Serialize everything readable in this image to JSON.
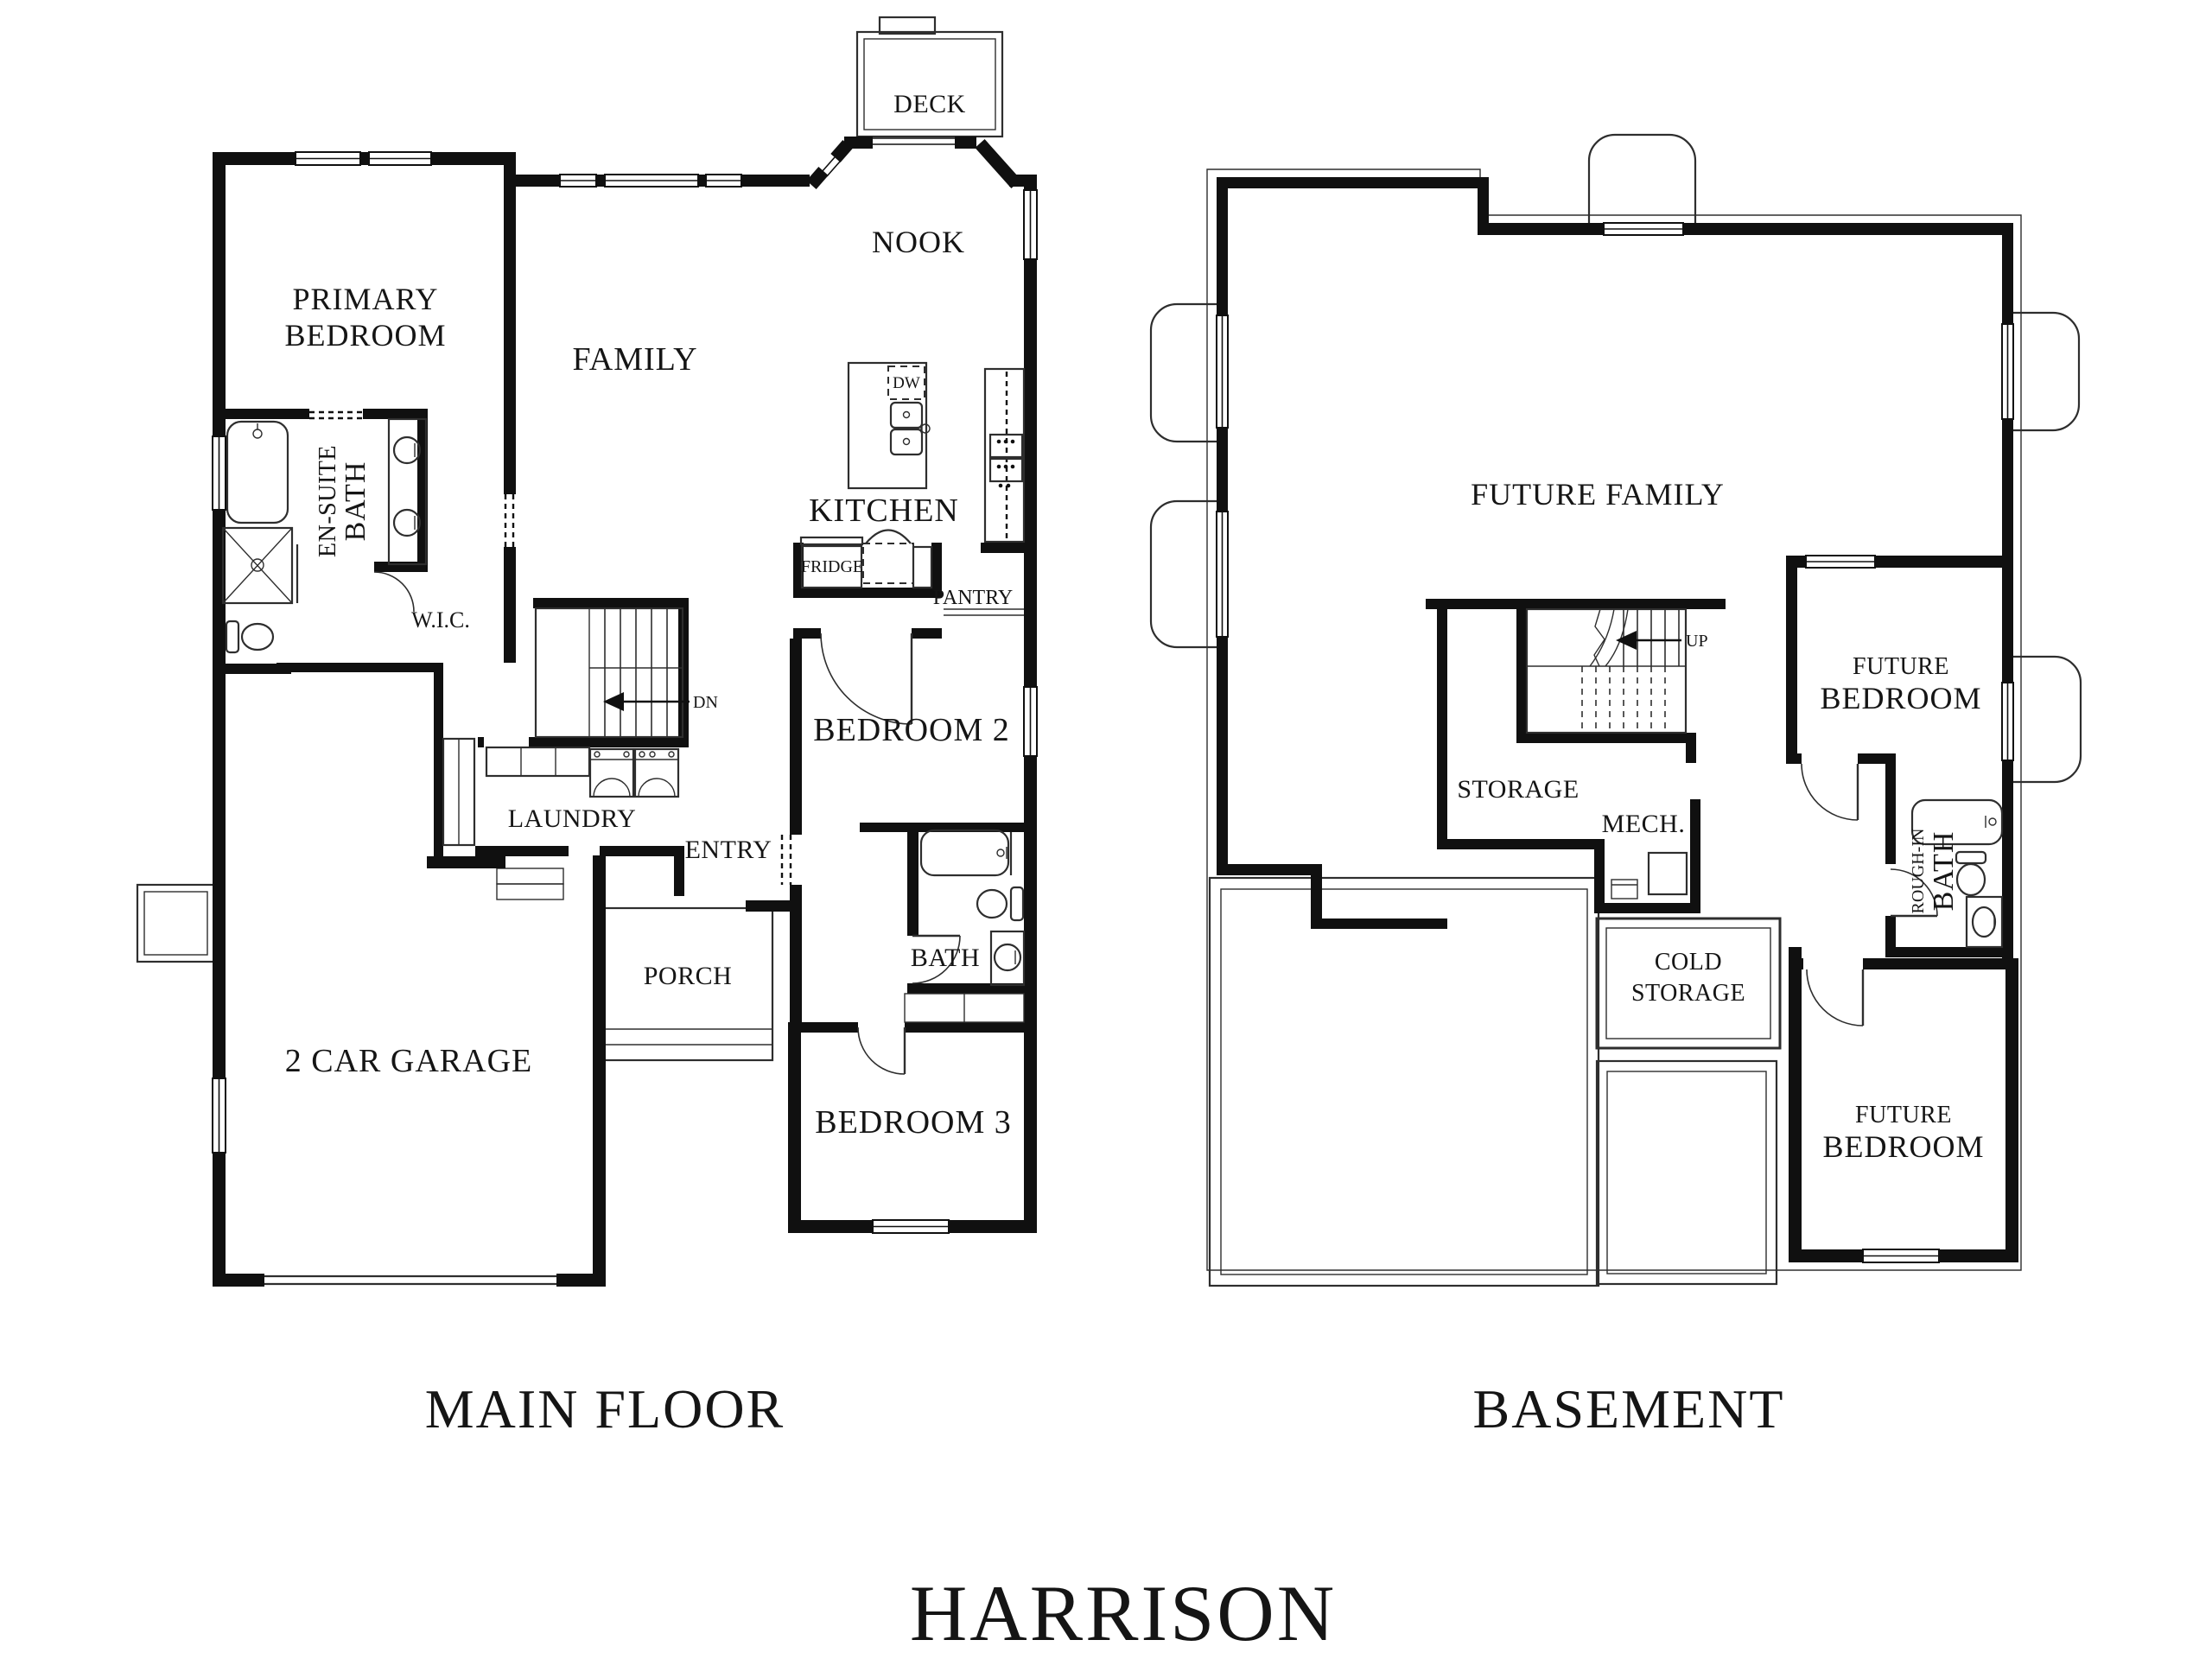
{
  "colors": {
    "walls": "#101010",
    "thin_lines": "#2e2e2e",
    "text": "#151515",
    "background": "#ffffff"
  },
  "title": "HARRISON",
  "main_floor": {
    "caption": "MAIN FLOOR",
    "labels": {
      "primary_bedroom": [
        "PRIMARY",
        "BEDROOM"
      ],
      "ensuite_bath": [
        "EN-SUITE",
        "BATH"
      ],
      "wic": "W.I.C.",
      "family": "FAMILY",
      "deck": "DECK",
      "nook": "NOOK",
      "kitchen": "KITCHEN",
      "dishwasher": "DW",
      "fridge": "FRIDGE",
      "pantry": "PANTRY",
      "stairs_down": "DN",
      "bedroom2": "BEDROOM 2",
      "laundry": "LAUNDRY",
      "entry": "ENTRY",
      "bath": "BATH",
      "porch": "PORCH",
      "garage": "2 CAR GARAGE",
      "bedroom3": "BEDROOM 3"
    }
  },
  "basement": {
    "caption": "BASEMENT",
    "labels": {
      "future_family": "FUTURE FAMILY",
      "stairs_up": "UP",
      "storage": "STORAGE",
      "mech": "MECH.",
      "cold_storage": [
        "COLD",
        "STORAGE"
      ],
      "future_bedroom_upper": [
        "FUTURE",
        "BEDROOM"
      ],
      "rough_in_bath": [
        "ROUGH-IN",
        "BATH"
      ],
      "future_bedroom_lower": [
        "FUTURE",
        "BEDROOM"
      ]
    }
  }
}
